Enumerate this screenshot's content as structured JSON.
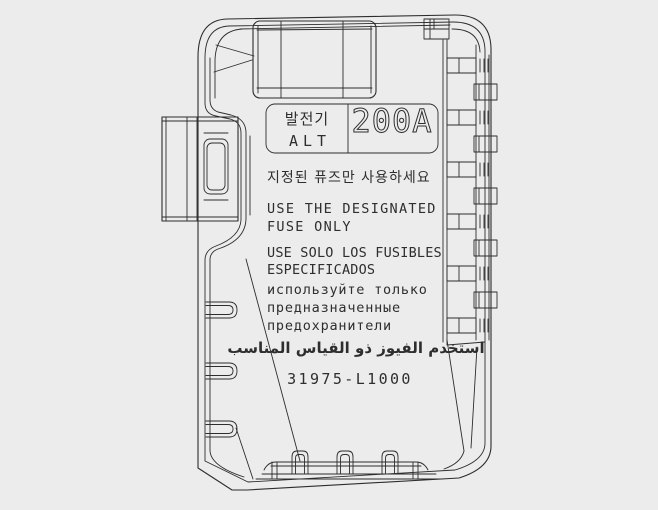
{
  "page": {
    "background_color": "#ececec",
    "line_color": "#2d2d2d",
    "text_color": "#2e2e2e"
  },
  "drawing": {
    "label_box": {
      "component_korean": "발전기",
      "component_abbr": "ALT",
      "amperage": "200A"
    },
    "warnings": {
      "korean": "지정된 퓨즈만 사용하세요",
      "english": [
        "USE THE DESIGNATED",
        "FUSE ONLY"
      ],
      "spanish": [
        "USE SOLO LOS FUSIBLES",
        "ESPECIFICADOS"
      ],
      "russian": [
        "используйте только",
        "предназначенные",
        "предохранители"
      ],
      "arabic": "استخدم الفيوز ذو القياس المناسب"
    },
    "part_number": "31975-L1000"
  }
}
